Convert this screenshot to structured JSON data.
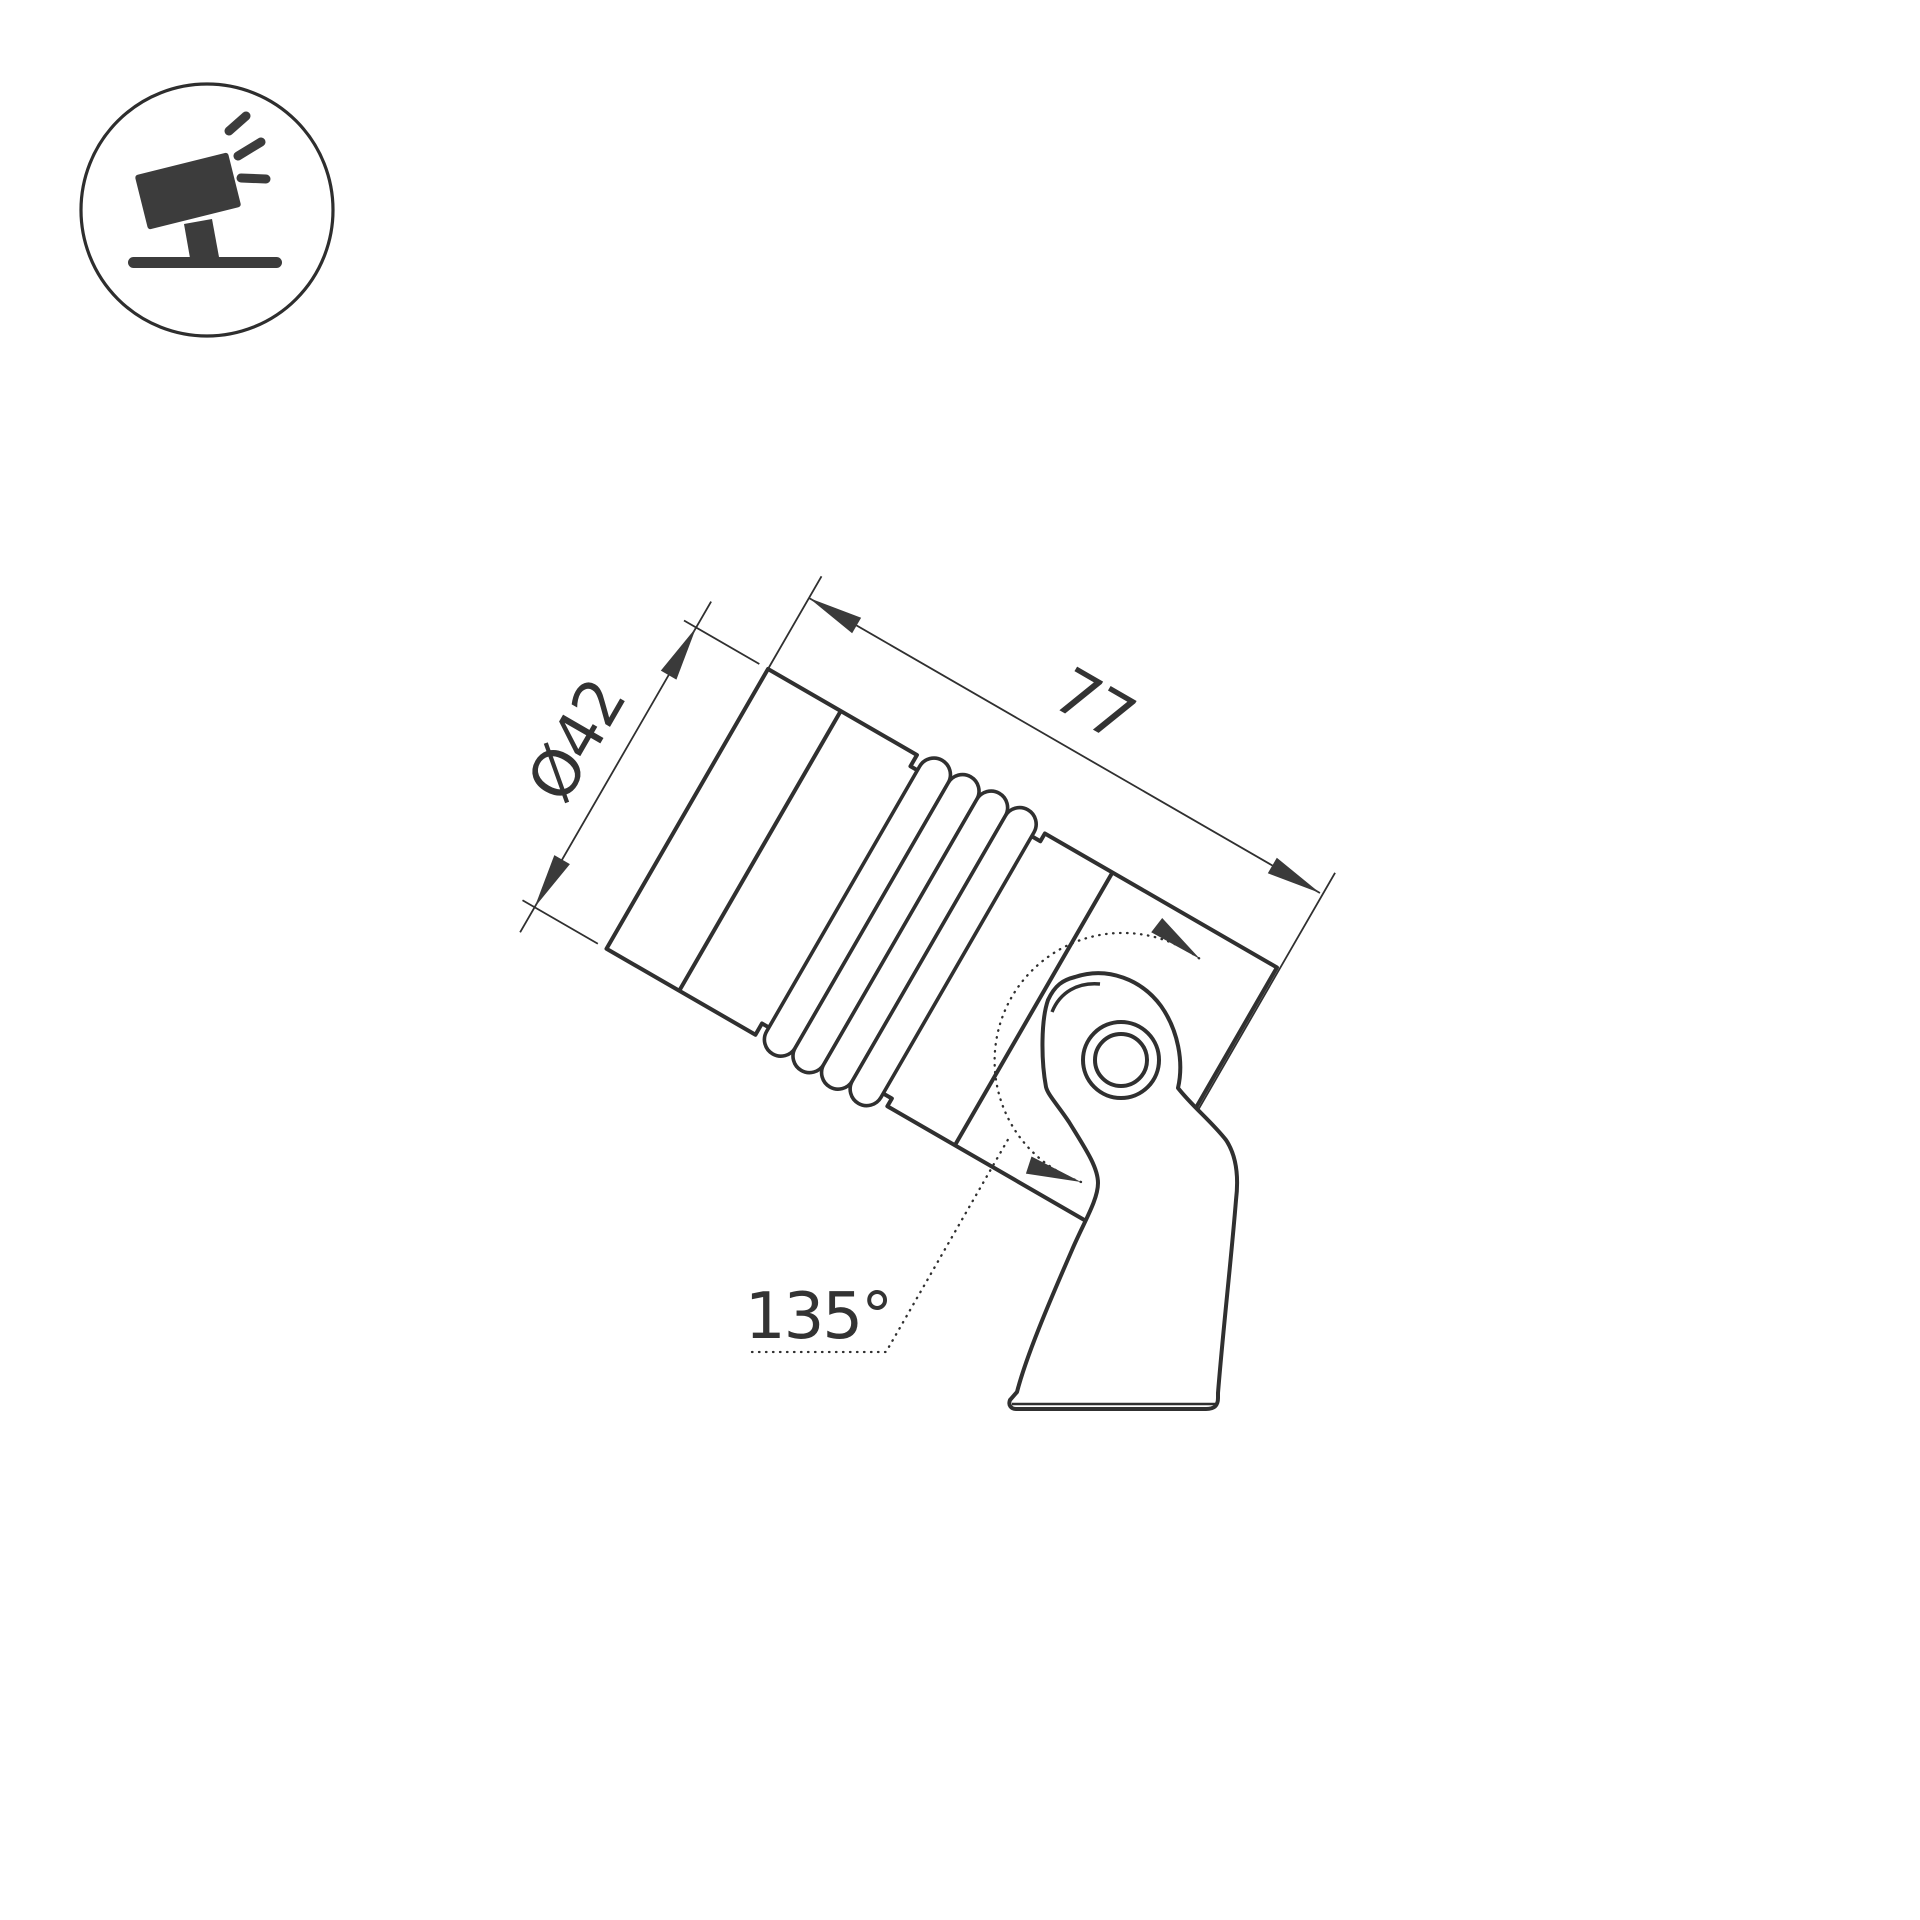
{
  "icon": {
    "name": "tilted-spotlight-pictogram"
  },
  "drawing": {
    "dimension_diameter": "Ø42",
    "dimension_length": "77",
    "dimension_angle": "135°"
  },
  "colors": {
    "background": "#ffffff",
    "line": "#303030",
    "arrow_fill": "#3a3a3a",
    "text": "#333333",
    "icon_fill": "#3c3c3c"
  }
}
